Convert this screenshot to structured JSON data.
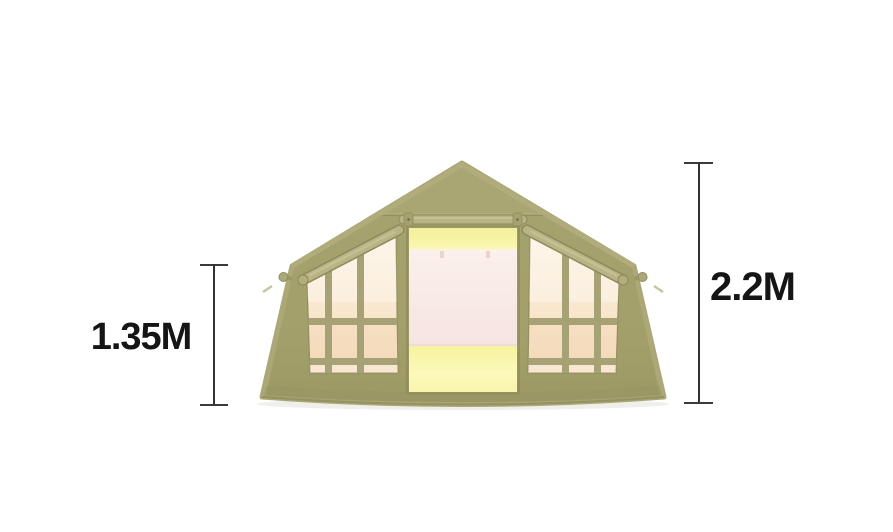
{
  "canvas": {
    "width": 893,
    "height": 532,
    "background": "#ffffff"
  },
  "illustration": "inflatable-cabin-tent-front-view",
  "dimensions": {
    "wall_height": {
      "label": "1.35M"
    },
    "peak_height": {
      "label": "2.2M"
    }
  },
  "colors": {
    "fabric": "#a3a06c",
    "fabric_roof": "#a9a674",
    "fabric_edge_highlight": "#b2ae7d",
    "fabric_outline": "#8e8b5a",
    "tube": "#b9b486",
    "glass_top": "#fdf2e0",
    "glass_bottom": "#f5dcbe",
    "door_glow_top": "#f2ef9b",
    "door_glow_top2": "#faf7b0",
    "door_glow_bottom": "#f6f3a0",
    "door_glow_bottom2": "#fcf9bb",
    "door_panel_top": "#fbf0ec",
    "door_panel_bottom": "#f6e4e0",
    "measure_line": "#323232",
    "label_text": "#151515"
  }
}
